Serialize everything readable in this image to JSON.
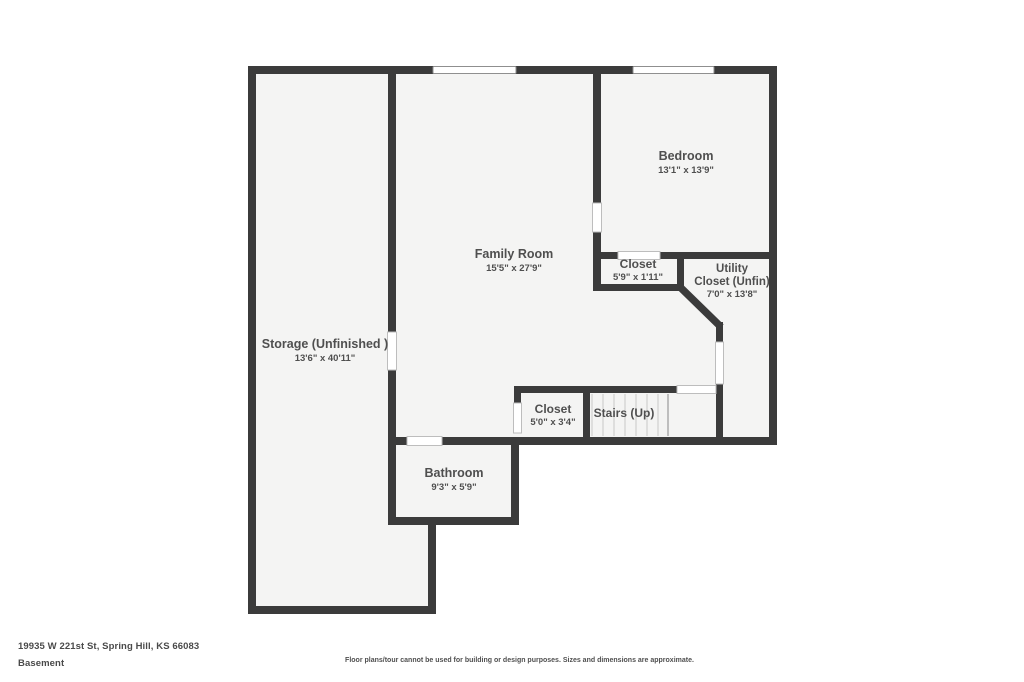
{
  "colors": {
    "wall": "#3b3b3b",
    "interior": "#f4f4f3",
    "background": "#ffffff",
    "label": "#4f4f4f",
    "window_border": "#8f8f8f",
    "opening_border": "#bdbdbd",
    "tread": "#c7c7c7",
    "nosing": "#9a9a9a"
  },
  "floorplan": {
    "interior_regions": [
      {
        "x": 252,
        "y": 70,
        "w": 140,
        "h": 540
      },
      {
        "x": 252,
        "y": 520,
        "w": 180,
        "h": 90
      },
      {
        "x": 392,
        "y": 70,
        "w": 381,
        "h": 371
      },
      {
        "x": 392,
        "y": 441,
        "w": 123,
        "h": 80
      }
    ],
    "walls": [
      {
        "x": 248,
        "y": 66,
        "w": 529,
        "h": 8
      },
      {
        "x": 248,
        "y": 66,
        "w": 8,
        "h": 548
      },
      {
        "x": 248,
        "y": 606,
        "w": 188,
        "h": 8
      },
      {
        "x": 428,
        "y": 517,
        "w": 8,
        "h": 97
      },
      {
        "x": 388,
        "y": 517,
        "w": 131,
        "h": 8
      },
      {
        "x": 511,
        "y": 437,
        "w": 8,
        "h": 88
      },
      {
        "x": 388,
        "y": 437,
        "w": 19,
        "h": 8
      },
      {
        "x": 442,
        "y": 437,
        "w": 335,
        "h": 8
      },
      {
        "x": 769,
        "y": 66,
        "w": 8,
        "h": 379
      },
      {
        "x": 388,
        "y": 66,
        "w": 8,
        "h": 266
      },
      {
        "x": 388,
        "y": 370,
        "w": 8,
        "h": 155
      },
      {
        "x": 593,
        "y": 66,
        "w": 8,
        "h": 137
      },
      {
        "x": 593,
        "y": 232,
        "w": 8,
        "h": 59
      },
      {
        "x": 593,
        "y": 252,
        "w": 25,
        "h": 7
      },
      {
        "x": 660,
        "y": 252,
        "w": 117,
        "h": 7
      },
      {
        "x": 593,
        "y": 284,
        "w": 91,
        "h": 7
      },
      {
        "x": 677,
        "y": 252,
        "w": 7,
        "h": 39
      },
      {
        "x": 716,
        "y": 322,
        "w": 7,
        "h": 20
      },
      {
        "x": 716,
        "y": 384,
        "w": 7,
        "h": 61
      },
      {
        "x": 514,
        "y": 386,
        "w": 163,
        "h": 7
      },
      {
        "x": 514,
        "y": 386,
        "w": 7,
        "h": 17
      },
      {
        "x": 583,
        "y": 393,
        "w": 7,
        "h": 44
      }
    ],
    "diagonal_wall": {
      "x1": 680,
      "y1": 287,
      "x2": 721,
      "y2": 327,
      "width": 7.5
    },
    "windows": [
      {
        "x": 433,
        "y": 66.5,
        "w": 83,
        "h": 7
      },
      {
        "x": 633,
        "y": 66.5,
        "w": 81,
        "h": 7
      }
    ],
    "openings": [
      {
        "x": 387.5,
        "y": 332,
        "w": 9,
        "h": 38
      },
      {
        "x": 592.5,
        "y": 203,
        "w": 9,
        "h": 29
      },
      {
        "x": 618,
        "y": 251.5,
        "w": 42,
        "h": 8
      },
      {
        "x": 715.5,
        "y": 342,
        "w": 8,
        "h": 42
      },
      {
        "x": 677,
        "y": 385.5,
        "w": 39,
        "h": 8
      },
      {
        "x": 513.5,
        "y": 403,
        "w": 8,
        "h": 30
      },
      {
        "x": 407,
        "y": 436.5,
        "w": 35,
        "h": 9
      }
    ],
    "stairs": {
      "treads_x": [
        592,
        603,
        614,
        625,
        636,
        647,
        658
      ],
      "nosing_x": 668,
      "y1": 394,
      "y2": 436
    },
    "rooms": [
      {
        "key": "storage",
        "name_lines": [
          {
            "t": "Storage (Unfinished )",
            "x": 325,
            "y": 348
          }
        ],
        "dims": {
          "t": "13'6\" x 40'11\"",
          "x": 325,
          "y": 361
        },
        "name_size": 12.5
      },
      {
        "key": "family-room",
        "name_lines": [
          {
            "t": "Family Room",
            "x": 514,
            "y": 258
          }
        ],
        "dims": {
          "t": "15'5\" x 27'9\"",
          "x": 514,
          "y": 271
        },
        "name_size": 12.5
      },
      {
        "key": "bedroom",
        "name_lines": [
          {
            "t": "Bedroom",
            "x": 686,
            "y": 160
          }
        ],
        "dims": {
          "t": "13'1\" x 13'9\"",
          "x": 686,
          "y": 173
        },
        "name_size": 12.5
      },
      {
        "key": "bedroom-closet",
        "name_lines": [
          {
            "t": "Closet",
            "x": 638,
            "y": 268
          }
        ],
        "dims": {
          "t": "5'9\" x 1'11\"",
          "x": 638,
          "y": 280
        },
        "name_size": 12
      },
      {
        "key": "utility-closet",
        "name_lines": [
          {
            "t": "Utility",
            "x": 732,
            "y": 272
          },
          {
            "t": "Closet (Unfin)",
            "x": 732,
            "y": 285
          }
        ],
        "dims": {
          "t": "7'0\" x 13'8\"",
          "x": 732,
          "y": 297
        },
        "name_size": 11.5
      },
      {
        "key": "stair-closet",
        "name_lines": [
          {
            "t": "Closet",
            "x": 553,
            "y": 413
          }
        ],
        "dims": {
          "t": "5'0\" x 3'4\"",
          "x": 553,
          "y": 425
        },
        "name_size": 12
      },
      {
        "key": "stairs",
        "name_lines": [
          {
            "t": "Stairs (Up)",
            "x": 624,
            "y": 417
          }
        ],
        "dims": null,
        "name_size": 12
      },
      {
        "key": "bathroom",
        "name_lines": [
          {
            "t": "Bathroom",
            "x": 454,
            "y": 477
          }
        ],
        "dims": {
          "t": "9'3\" x 5'9\"",
          "x": 454,
          "y": 490
        },
        "name_size": 12.5
      }
    ]
  },
  "footer": {
    "address": "19935 W 221st St, Spring Hill, KS 66083",
    "level": "Basement",
    "disclaimer": "Floor plans/tour cannot be used for building or design purposes. Sizes and dimensions are approximate."
  }
}
